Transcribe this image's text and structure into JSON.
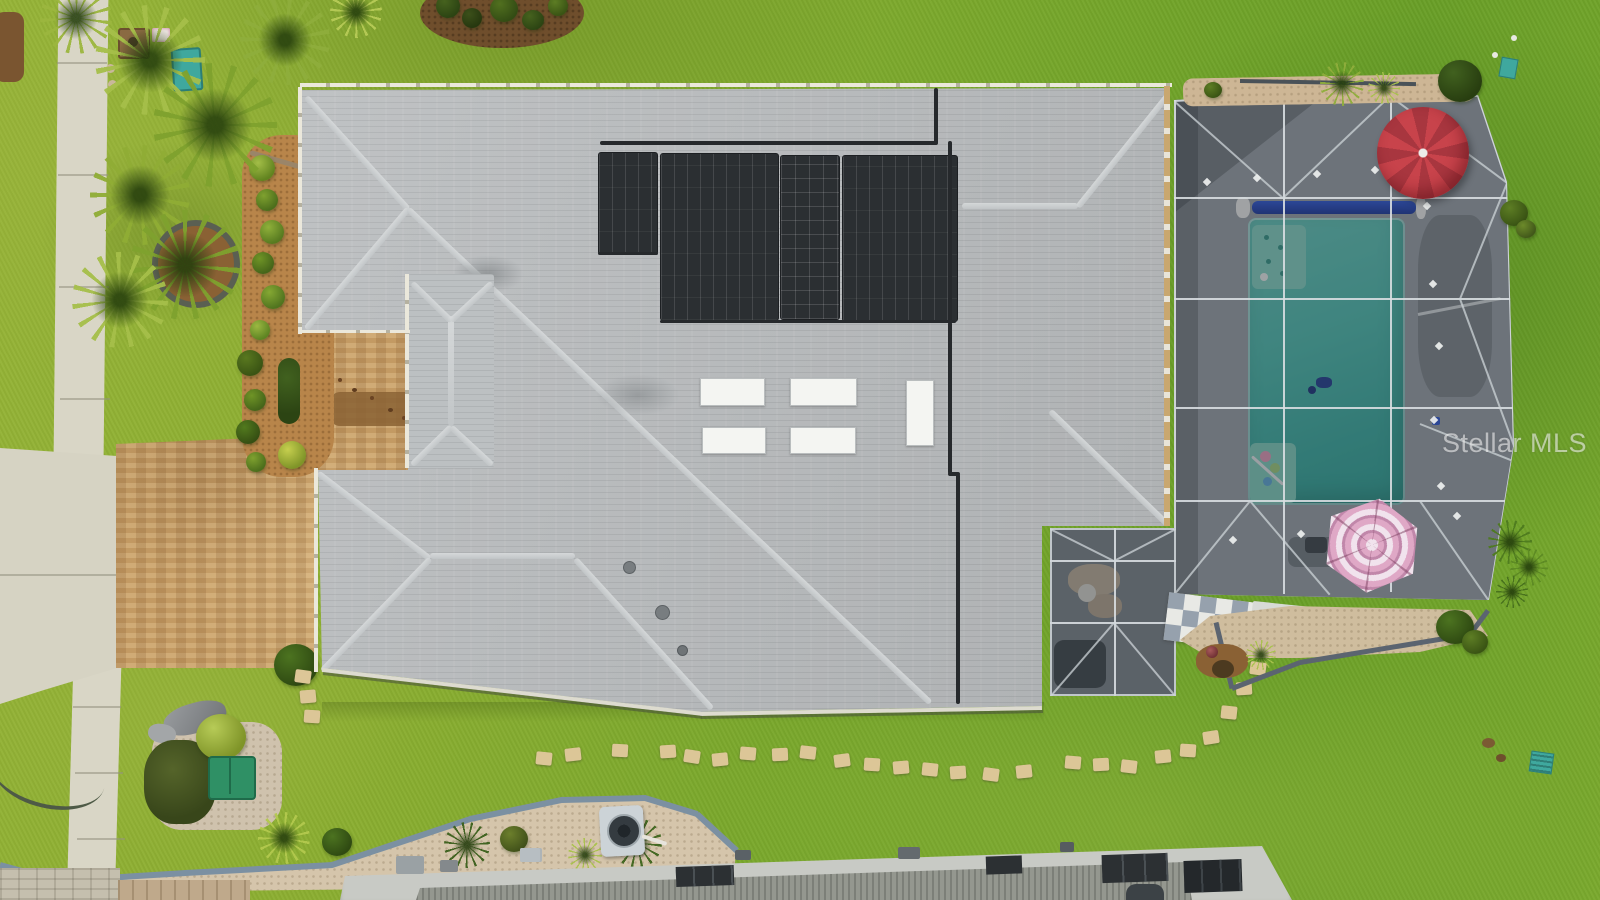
{
  "watermark": {
    "text": "Stellar MLS"
  },
  "scene": {
    "type": "aerial-drone-photo",
    "description": "Overhead drone view of a single-family Florida home: gray shingle hip roof with solar pool-heating panels and skylights, screened pool enclosure with turquoise pool, red and pink patio umbrellas, paver driveway, concrete sidewalk, palm trees, shrubs, gravel beds, stepping-stone path, AC unit, green utility box, and neighboring rooftops along the bottom edge.",
    "colors": {
      "lawn": "#85aa2e",
      "roof_shingle": "#b9bcbe",
      "ridge_cap": "#d6d9da",
      "solar_panel": "#2b2f32",
      "pool_water": "#3fbcae",
      "pool_cover_roller": "#2a55d8",
      "screen_enclosure": "#4a5258",
      "screen_frame": "#d6dce0",
      "red_umbrella": "#c8434b",
      "pink_umbrella": "#dfa8c6",
      "paver_driveway": "#c39a63",
      "concrete": "#d9d6c6",
      "gravel_bed": "#d5c5ab",
      "stepping_stone": "#dcc697",
      "utility_box_green": "#2f9065",
      "teal_accent": "#3fa89e",
      "flat_roof_neighbor": "#c8cac5",
      "curb_edging": "#7b90a2"
    },
    "objects": [
      "house-roof",
      "solar-panel-array",
      "skylights",
      "pool-screen-enclosure",
      "swimming-pool",
      "tanning-shelf",
      "pool-cover-roller",
      "red-umbrella",
      "pink-umbrella",
      "lanai",
      "checkerboard-patio",
      "paver-driveway",
      "sidewalk",
      "palm-trees",
      "shrubs",
      "stepping-stones",
      "ac-unit",
      "green-utility-box",
      "gravel-beds",
      "neighbor-flat-roof"
    ]
  }
}
